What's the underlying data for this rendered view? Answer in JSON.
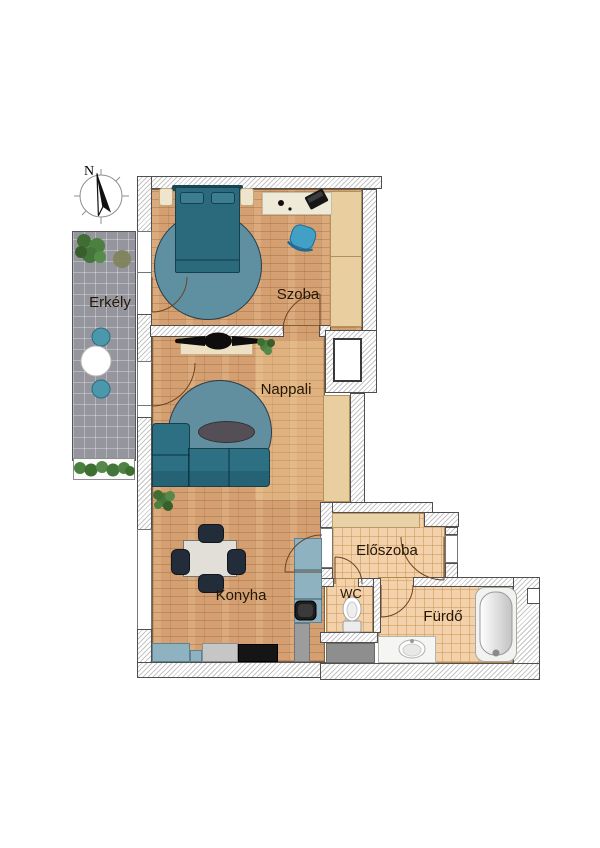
{
  "compass": {
    "north_label": "N"
  },
  "rooms": {
    "erkely": {
      "label": "Erkély"
    },
    "szoba": {
      "label": "Szoba"
    },
    "nappali": {
      "label": "Nappali"
    },
    "konyha": {
      "label": "Konyha"
    },
    "eloszoba": {
      "label": "Előszoba"
    },
    "wc": {
      "label": "WC"
    },
    "furdo": {
      "label": "Fürdő"
    }
  },
  "colors": {
    "wood_floor": "#d5a071",
    "tile_floor": "#f3d2ab",
    "balcony_tile": "#95959d",
    "furniture_teal": "#2d7084",
    "rug_blue": "#628fa0",
    "kitchen_cabinet": "#8fb2c0",
    "desk_chair_blue": "#429fc6",
    "wall_outline": "#4f4f4f",
    "label_text": "#241706"
  }
}
